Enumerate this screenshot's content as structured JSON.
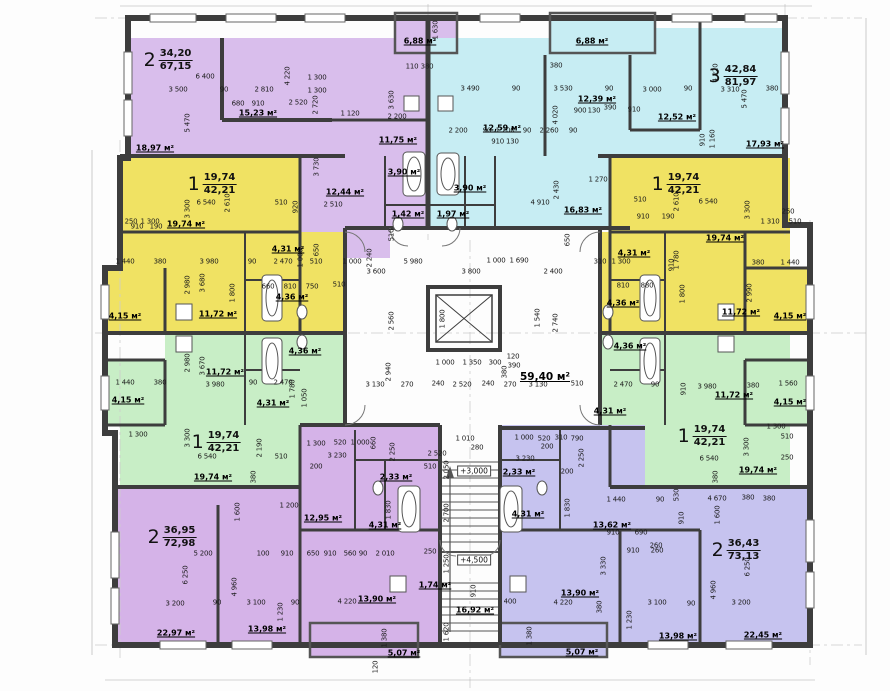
{
  "title": "apartment-building-floor-plan",
  "colors": {
    "purple": "#d9beec",
    "purple2": "#d5b3e8",
    "cyan": "#c7edf3",
    "yellow": "#f0e263",
    "green": "#c8eec6",
    "blue": "#c6c3ef",
    "wall": "#3d3d3d"
  },
  "apartments": [
    {
      "num": "2",
      "area": "34,20",
      "total": "67,15",
      "x": 168,
      "y": 60
    },
    {
      "num": "3",
      "area": "42,84",
      "total": "81,97",
      "x": 733,
      "y": 76
    },
    {
      "num": "1",
      "area": "19,74",
      "total": "42,21",
      "x": 212,
      "y": 184
    },
    {
      "num": "1",
      "area": "19,74",
      "total": "42,21",
      "x": 676,
      "y": 184
    },
    {
      "num": "1",
      "area": "19,74",
      "total": "42,21",
      "x": 216,
      "y": 442
    },
    {
      "num": "1",
      "area": "19,74",
      "total": "42,21",
      "x": 702,
      "y": 436
    },
    {
      "num": "2",
      "area": "36,95",
      "total": "72,98",
      "x": 172,
      "y": 537
    },
    {
      "num": "2",
      "area": "36,43",
      "total": "73,13",
      "x": 736,
      "y": 550
    }
  ],
  "levels": [
    {
      "t": "+3,000",
      "x": 474,
      "y": 471
    },
    {
      "t": "+4,500",
      "x": 474,
      "y": 560
    }
  ],
  "room_areas": [
    [
      "18,97 м²",
      155,
      148
    ],
    [
      "15,23 м²",
      258,
      113
    ],
    [
      "12,44 м²",
      345,
      192
    ],
    [
      "11,75 м²",
      398,
      140
    ],
    [
      "3,90 м²",
      404,
      172
    ],
    [
      "1,42 м²",
      408,
      214
    ],
    [
      "6,88 м²",
      420,
      41
    ],
    [
      "6,88 м²",
      592,
      41
    ],
    [
      "12,59 м²",
      502,
      128
    ],
    [
      "3,90 м²",
      470,
      188
    ],
    [
      "1,97 м²",
      453,
      214
    ],
    [
      "12,39 м²",
      597,
      99
    ],
    [
      "12,52 м²",
      677,
      117
    ],
    [
      "16,83 м²",
      583,
      210
    ],
    [
      "17,93 м²",
      765,
      144
    ],
    [
      "19,74 м²",
      186,
      224
    ],
    [
      "4,31 м²",
      288,
      249
    ],
    [
      "4,36 м²",
      292,
      297
    ],
    [
      "11,72 м²",
      218,
      314
    ],
    [
      "4,15 м²",
      125,
      316
    ],
    [
      "11,72 м²",
      225,
      372
    ],
    [
      "4,36 м²",
      305,
      351
    ],
    [
      "4,31 м²",
      273,
      403
    ],
    [
      "4,15 м²",
      128,
      400
    ],
    [
      "19,74 м²",
      213,
      477
    ],
    [
      "19,74 м²",
      725,
      238
    ],
    [
      "4,31 м²",
      634,
      253
    ],
    [
      "4,36 м²",
      623,
      303
    ],
    [
      "11,72 м²",
      741,
      312
    ],
    [
      "4,15 м²",
      790,
      316
    ],
    [
      "4,36 м²",
      630,
      346
    ],
    [
      "11,72 м²",
      734,
      395
    ],
    [
      "4,31 м²",
      610,
      411
    ],
    [
      "4,15 м²",
      790,
      402
    ],
    [
      "19,74 м²",
      758,
      470
    ],
    [
      "59,40 м²",
      545,
      377,
      1
    ],
    [
      "12,95 м²",
      323,
      518
    ],
    [
      "2,33 м²",
      396,
      477
    ],
    [
      "4,31 м²",
      385,
      525
    ],
    [
      "2,33 м²",
      519,
      472
    ],
    [
      "4,31 м²",
      528,
      514
    ],
    [
      "13,62 м²",
      612,
      525
    ],
    [
      "1,74 м²",
      435,
      585
    ],
    [
      "16,92 м²",
      475,
      610
    ],
    [
      "13,90 м²",
      377,
      599
    ],
    [
      "13,90 м²",
      580,
      593
    ],
    [
      "22,97 м²",
      176,
      633
    ],
    [
      "13,98 м²",
      267,
      629
    ],
    [
      "13,98 м²",
      678,
      636
    ],
    [
      "22,45 м²",
      763,
      635
    ],
    [
      "5,07 м²",
      404,
      653
    ],
    [
      "5,07 м²",
      582,
      652
    ]
  ],
  "dims": [
    [
      "6 400",
      205,
      77
    ],
    [
      "3 500",
      178,
      90
    ],
    [
      "90",
      224,
      90
    ],
    [
      "2 810",
      264,
      90
    ],
    [
      "680",
      238,
      104
    ],
    [
      "910",
      258,
      104
    ],
    [
      "2 520",
      298,
      103
    ],
    [
      "5 470",
      188,
      123,
      1
    ],
    [
      "4 220",
      288,
      76,
      1
    ],
    [
      "1 300",
      317,
      78
    ],
    [
      "1 300",
      317,
      91
    ],
    [
      "2 720",
      316,
      105,
      1
    ],
    [
      "1 120",
      350,
      114
    ],
    [
      "2 200",
      397,
      117
    ],
    [
      "3 630",
      392,
      100,
      1
    ],
    [
      "3 730",
      317,
      167,
      1
    ],
    [
      "2 510",
      333,
      205
    ],
    [
      "920",
      296,
      207,
      1
    ],
    [
      "110",
      412,
      67
    ],
    [
      "380",
      427,
      67
    ],
    [
      "1 630",
      436,
      30,
      1
    ],
    [
      "3 490",
      470,
      89
    ],
    [
      "90",
      516,
      89
    ],
    [
      "3 530",
      563,
      89
    ],
    [
      "90",
      609,
      89
    ],
    [
      "900",
      580,
      111
    ],
    [
      "130",
      594,
      111
    ],
    [
      "390",
      610,
      108
    ],
    [
      "910",
      634,
      110
    ],
    [
      "4 020",
      556,
      115,
      1
    ],
    [
      "2 200",
      458,
      131
    ],
    [
      "90",
      487,
      131
    ],
    [
      "1 200",
      505,
      131
    ],
    [
      "90",
      527,
      131
    ],
    [
      "2 260",
      549,
      131
    ],
    [
      "90",
      573,
      131
    ],
    [
      "910 130",
      505,
      142
    ],
    [
      "2 430",
      557,
      190,
      1
    ],
    [
      "4 910",
      540,
      203
    ],
    [
      "1 270",
      598,
      180
    ],
    [
      "380",
      556,
      66
    ],
    [
      "3 000",
      652,
      90
    ],
    [
      "90",
      688,
      89
    ],
    [
      "3 310",
      730,
      90
    ],
    [
      "380",
      772,
      89
    ],
    [
      "4 220",
      716,
      73,
      1
    ],
    [
      "5 470",
      745,
      99,
      1
    ],
    [
      "1 160",
      713,
      139,
      1
    ],
    [
      "910",
      703,
      140,
      1
    ],
    [
      "250",
      131,
      222
    ],
    [
      "1 300",
      150,
      222
    ],
    [
      "6 540",
      206,
      203
    ],
    [
      "2 610",
      228,
      203,
      1
    ],
    [
      "510",
      281,
      203
    ],
    [
      "3 300",
      188,
      209,
      1
    ],
    [
      "910",
      137,
      227
    ],
    [
      "190",
      156,
      227
    ],
    [
      "1 440",
      125,
      262
    ],
    [
      "380",
      160,
      262
    ],
    [
      "3 980",
      209,
      262
    ],
    [
      "90",
      252,
      262
    ],
    [
      "2 470",
      283,
      262
    ],
    [
      "1 000",
      301,
      258,
      1
    ],
    [
      "510",
      316,
      262
    ],
    [
      "1 000",
      352,
      262
    ],
    [
      "2 980",
      188,
      285,
      1
    ],
    [
      "3 680",
      203,
      283,
      1
    ],
    [
      "1 800",
      233,
      293,
      1
    ],
    [
      "660",
      268,
      287
    ],
    [
      "810",
      290,
      287
    ],
    [
      "750",
      312,
      287
    ],
    [
      "510",
      339,
      285
    ],
    [
      "650",
      317,
      250,
      1
    ],
    [
      "310",
      600,
      262
    ],
    [
      "1 300",
      621,
      262
    ],
    [
      "1 440",
      790,
      263
    ],
    [
      "380",
      758,
      263
    ],
    [
      "2 990",
      750,
      293,
      1
    ],
    [
      "1 780",
      677,
      260,
      1
    ],
    [
      "1 800",
      683,
      294,
      1
    ],
    [
      "880",
      647,
      286
    ],
    [
      "810",
      623,
      286
    ],
    [
      "910",
      672,
      265,
      1
    ],
    [
      "6 540",
      708,
      202
    ],
    [
      "510",
      640,
      200
    ],
    [
      "2 610",
      677,
      202,
      1
    ],
    [
      "3 300",
      748,
      210,
      1
    ],
    [
      "250",
      788,
      212
    ],
    [
      "1 310",
      770,
      222
    ],
    [
      "510",
      795,
      222
    ],
    [
      "910",
      643,
      217
    ],
    [
      "190",
      668,
      217
    ],
    [
      "1 440",
      125,
      383
    ],
    [
      "380",
      160,
      383
    ],
    [
      "3 980",
      215,
      385
    ],
    [
      "90",
      253,
      383
    ],
    [
      "2 470",
      283,
      383
    ],
    [
      "1 780",
      293,
      389,
      1
    ],
    [
      "1 050",
      305,
      398,
      1
    ],
    [
      "2 980",
      188,
      363,
      1
    ],
    [
      "3 670",
      203,
      366,
      1
    ],
    [
      "1 300",
      138,
      435
    ],
    [
      "3 300",
      188,
      438,
      1
    ],
    [
      "6 540",
      207,
      457
    ],
    [
      "510",
      281,
      457
    ],
    [
      "2 190",
      260,
      448,
      1
    ],
    [
      "380",
      254,
      477,
      1
    ],
    [
      "2 470",
      623,
      385
    ],
    [
      "90",
      655,
      385
    ],
    [
      "3 980",
      707,
      387
    ],
    [
      "380",
      753,
      386
    ],
    [
      "1 560",
      788,
      384
    ],
    [
      "910",
      684,
      389,
      1
    ],
    [
      "1 300",
      776,
      427
    ],
    [
      "510",
      787,
      437
    ],
    [
      "250",
      787,
      458
    ],
    [
      "6 540",
      709,
      459
    ],
    [
      "3 300",
      747,
      447,
      1
    ],
    [
      "380",
      716,
      477,
      1
    ],
    [
      "5 980",
      413,
      262
    ],
    [
      "1 000",
      496,
      261
    ],
    [
      "1 690",
      519,
      261
    ],
    [
      "3 600",
      376,
      272
    ],
    [
      "3 800",
      471,
      272
    ],
    [
      "2 400",
      553,
      272
    ],
    [
      "2 240",
      370,
      258,
      1
    ],
    [
      "2 560",
      392,
      321,
      1
    ],
    [
      "2 940",
      389,
      372,
      1
    ],
    [
      "2 740",
      556,
      323,
      1
    ],
    [
      "1 540",
      538,
      318,
      1
    ],
    [
      "3 130",
      375,
      385
    ],
    [
      "270",
      407,
      385
    ],
    [
      "240",
      438,
      384
    ],
    [
      "2 520",
      462,
      385
    ],
    [
      "240",
      488,
      384
    ],
    [
      "270",
      510,
      385
    ],
    [
      "3 130",
      538,
      385
    ],
    [
      "510",
      577,
      384
    ],
    [
      "1 000",
      445,
      363
    ],
    [
      "1 350",
      472,
      363
    ],
    [
      "300",
      495,
      363
    ],
    [
      "380",
      505,
      372,
      1
    ],
    [
      "390",
      514,
      366
    ],
    [
      "120",
      513,
      357
    ],
    [
      "1 800",
      443,
      319,
      1
    ],
    [
      "650",
      568,
      240,
      1
    ],
    [
      "510",
      392,
      235,
      1
    ],
    [
      "2 520",
      437,
      454
    ],
    [
      "510",
      430,
      467
    ],
    [
      "2 050",
      447,
      470,
      1
    ],
    [
      "2 700",
      447,
      513,
      1
    ],
    [
      "250",
      430,
      552
    ],
    [
      "1 250",
      447,
      564,
      1
    ],
    [
      "910",
      474,
      591,
      1
    ],
    [
      "1 620",
      447,
      632,
      1
    ],
    [
      "1 010",
      465,
      439
    ],
    [
      "280",
      477,
      448
    ],
    [
      "5 200",
      203,
      554
    ],
    [
      "100",
      263,
      554
    ],
    [
      "910",
      287,
      554
    ],
    [
      "650",
      313,
      554
    ],
    [
      "910",
      330,
      554
    ],
    [
      "560",
      350,
      554
    ],
    [
      "90",
      363,
      554
    ],
    [
      "2 010",
      385,
      554
    ],
    [
      "6 250",
      186,
      575,
      1
    ],
    [
      "4 960",
      235,
      587,
      1
    ],
    [
      "3 200",
      175,
      604
    ],
    [
      "90",
      217,
      603
    ],
    [
      "3 100",
      256,
      603
    ],
    [
      "90",
      295,
      603
    ],
    [
      "4 220",
      347,
      602
    ],
    [
      "1 230",
      281,
      612,
      1
    ],
    [
      "1 300",
      316,
      444
    ],
    [
      "520",
      340,
      443
    ],
    [
      "1 000",
      360,
      443
    ],
    [
      "660",
      374,
      443,
      1
    ],
    [
      "3 230",
      337,
      456
    ],
    [
      "200",
      316,
      467
    ],
    [
      "1 200",
      289,
      506
    ],
    [
      "1 600",
      238,
      512,
      1
    ],
    [
      "2 250",
      393,
      452,
      1
    ],
    [
      "1 830",
      389,
      510,
      1
    ],
    [
      "1 380",
      385,
      638,
      1
    ],
    [
      "120",
      376,
      667,
      1
    ],
    [
      "1 000",
      524,
      438
    ],
    [
      "520",
      544,
      439
    ],
    [
      "310",
      561,
      438
    ],
    [
      "790",
      577,
      439
    ],
    [
      "200",
      547,
      447
    ],
    [
      "3 230",
      525,
      459
    ],
    [
      "2 250",
      582,
      458,
      1
    ],
    [
      "200",
      567,
      472
    ],
    [
      "1 440",
      616,
      500
    ],
    [
      "1 830",
      568,
      508,
      1
    ],
    [
      "910",
      613,
      533
    ],
    [
      "690",
      641,
      533
    ],
    [
      "260",
      656,
      546
    ],
    [
      "3 330",
      604,
      566,
      1
    ],
    [
      "400",
      510,
      602
    ],
    [
      "4 220",
      563,
      603
    ],
    [
      "380",
      600,
      607,
      1
    ],
    [
      "90",
      660,
      500
    ],
    [
      "530",
      677,
      495,
      1
    ],
    [
      "4 670",
      717,
      499
    ],
    [
      "380",
      748,
      498
    ],
    [
      "380",
      769,
      499
    ],
    [
      "1 600",
      718,
      515,
      1
    ],
    [
      "910",
      682,
      518,
      1
    ],
    [
      "6 250",
      748,
      567,
      1
    ],
    [
      "4 960",
      714,
      590,
      1
    ],
    [
      "3 100",
      657,
      603
    ],
    [
      "90",
      691,
      604
    ],
    [
      "3 200",
      741,
      603
    ],
    [
      "910",
      633,
      551
    ],
    [
      "260",
      657,
      551
    ],
    [
      "1 230",
      630,
      620,
      1
    ],
    [
      "1 380",
      530,
      636,
      1
    ]
  ],
  "regions": [
    [
      128,
      38,
      94,
      120,
      "purple"
    ],
    [
      222,
      38,
      110,
      120,
      "purple"
    ],
    [
      332,
      38,
      96,
      120,
      "purple"
    ],
    [
      222,
      120,
      110,
      38,
      "purple"
    ],
    [
      300,
      158,
      128,
      72,
      "purple"
    ],
    [
      300,
      230,
      90,
      28,
      "purple"
    ],
    [
      395,
      15,
      62,
      38,
      "purple"
    ],
    [
      428,
      38,
      117,
      120,
      "cyan"
    ],
    [
      545,
      38,
      85,
      120,
      "cyan"
    ],
    [
      630,
      28,
      155,
      130,
      "cyan"
    ],
    [
      428,
      158,
      202,
      72,
      "cyan"
    ],
    [
      550,
      15,
      105,
      38,
      "cyan"
    ],
    [
      120,
      158,
      180,
      74,
      "yellow"
    ],
    [
      165,
      232,
      180,
      101,
      "yellow"
    ],
    [
      103,
      268,
      62,
      65,
      "yellow"
    ],
    [
      120,
      232,
      45,
      36,
      "yellow"
    ],
    [
      610,
      158,
      180,
      74,
      "yellow"
    ],
    [
      600,
      232,
      190,
      101,
      "yellow"
    ],
    [
      745,
      268,
      65,
      65,
      "yellow"
    ],
    [
      745,
      232,
      45,
      36,
      "yellow"
    ],
    [
      165,
      333,
      180,
      92,
      "green"
    ],
    [
      103,
      360,
      62,
      65,
      "green"
    ],
    [
      120,
      425,
      180,
      62,
      "green"
    ],
    [
      120,
      395,
      45,
      30,
      "green"
    ],
    [
      600,
      333,
      190,
      92,
      "green"
    ],
    [
      745,
      360,
      65,
      65,
      "green"
    ],
    [
      610,
      425,
      180,
      62,
      "green"
    ],
    [
      115,
      487,
      185,
      158,
      "purple2"
    ],
    [
      300,
      425,
      140,
      220,
      "purple2"
    ],
    [
      310,
      625,
      108,
      32,
      "purple2"
    ],
    [
      500,
      425,
      145,
      220,
      "blue"
    ],
    [
      645,
      487,
      165,
      158,
      "blue"
    ],
    [
      500,
      625,
      107,
      32,
      "blue"
    ]
  ]
}
